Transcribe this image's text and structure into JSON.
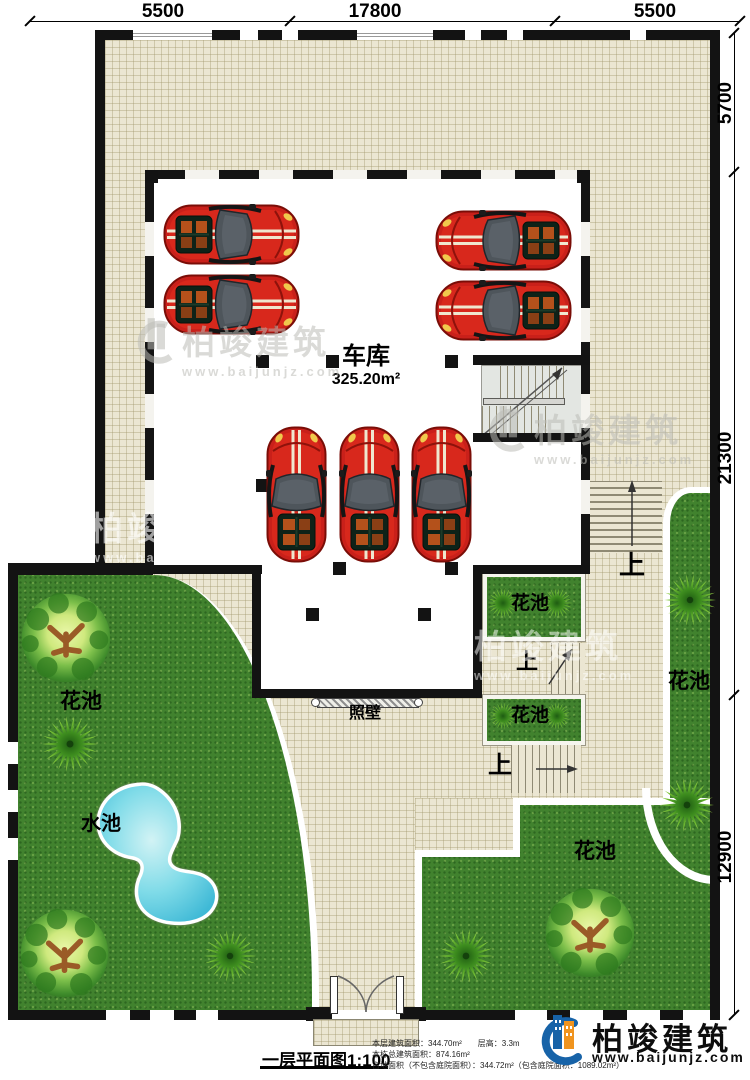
{
  "dims": {
    "top": [
      "5500",
      "17800",
      "5500"
    ],
    "right": [
      "5700",
      "21300",
      "12900"
    ]
  },
  "garage": {
    "name": "车库",
    "area": "325.20m²"
  },
  "labels": {
    "flower_bed": "花池",
    "water_pool": "水池",
    "screen_wall": "照壁",
    "up": "上"
  },
  "watermark": {
    "name": "柏竣建筑",
    "site": "www.baijunjz.com"
  },
  "footer": {
    "plan_title": "一层平面图1:100",
    "info": [
      "本层建筑面积：344.70m²　　层高：3.3m",
      "本栋总建筑面积：874.16m²",
      "占地面积（不包含庭院面积）：344.72m²（包含庭院面积：1089.02m²）"
    ],
    "brand": "柏竣建筑",
    "site": "www.baijunjz.com"
  },
  "colors": {
    "wall": "#131313",
    "grass": "#41822e",
    "tile": "#ebe6d2",
    "car_red": "#c9201a",
    "pool_blue": "#3fb9d6",
    "brand_blue": "#1763a8",
    "brand_orange": "#f0941f"
  }
}
